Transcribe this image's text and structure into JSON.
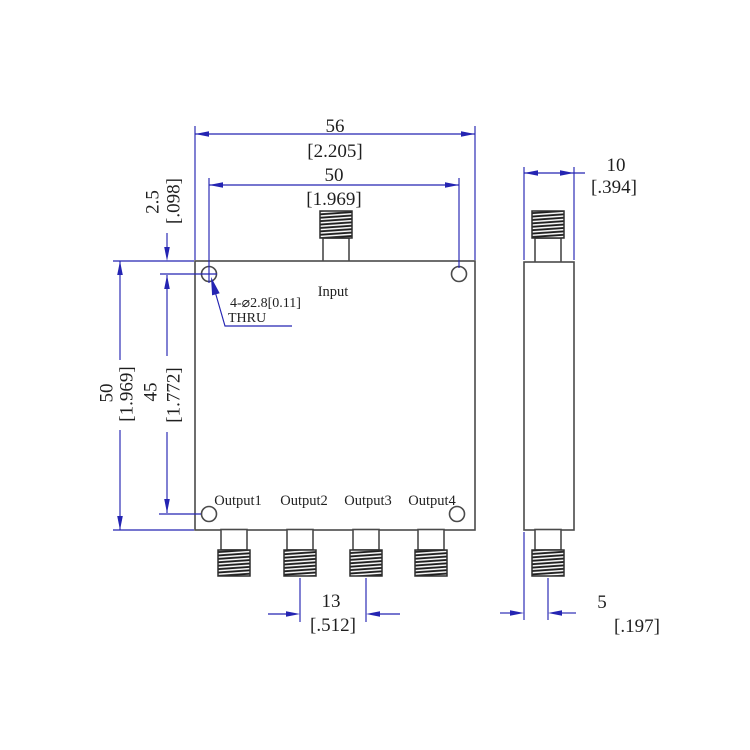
{
  "front_view": {
    "input_label": "Input",
    "outputs": [
      "Output1",
      "Output2",
      "Output3",
      "Output4"
    ],
    "hole_note": {
      "line1": "4-⌀2.8[0.11]",
      "line2": "THRU"
    }
  },
  "dims": {
    "overall_width": {
      "mm": "56",
      "in": "[2.205]"
    },
    "mount_span_x": {
      "mm": "50",
      "in": "[1.969]"
    },
    "hole_top_offset": {
      "mm": "2.5",
      "in": "[.098]"
    },
    "overall_height": {
      "mm": "50",
      "in": "[1.969]"
    },
    "mount_span_y": {
      "mm": "45",
      "in": "[1.772]"
    },
    "output_pitch": {
      "mm": "13",
      "in": "[.512]"
    },
    "body_thickness": {
      "mm": "10",
      "in": "[.394]"
    },
    "connector_offset": {
      "mm": "5",
      "in": "[.197]"
    }
  },
  "colors": {
    "dimension_blue": "#2424b2",
    "geometry_gray": "#4a4a4a",
    "text_black": "#1f1f1f",
    "background": "#ffffff"
  }
}
